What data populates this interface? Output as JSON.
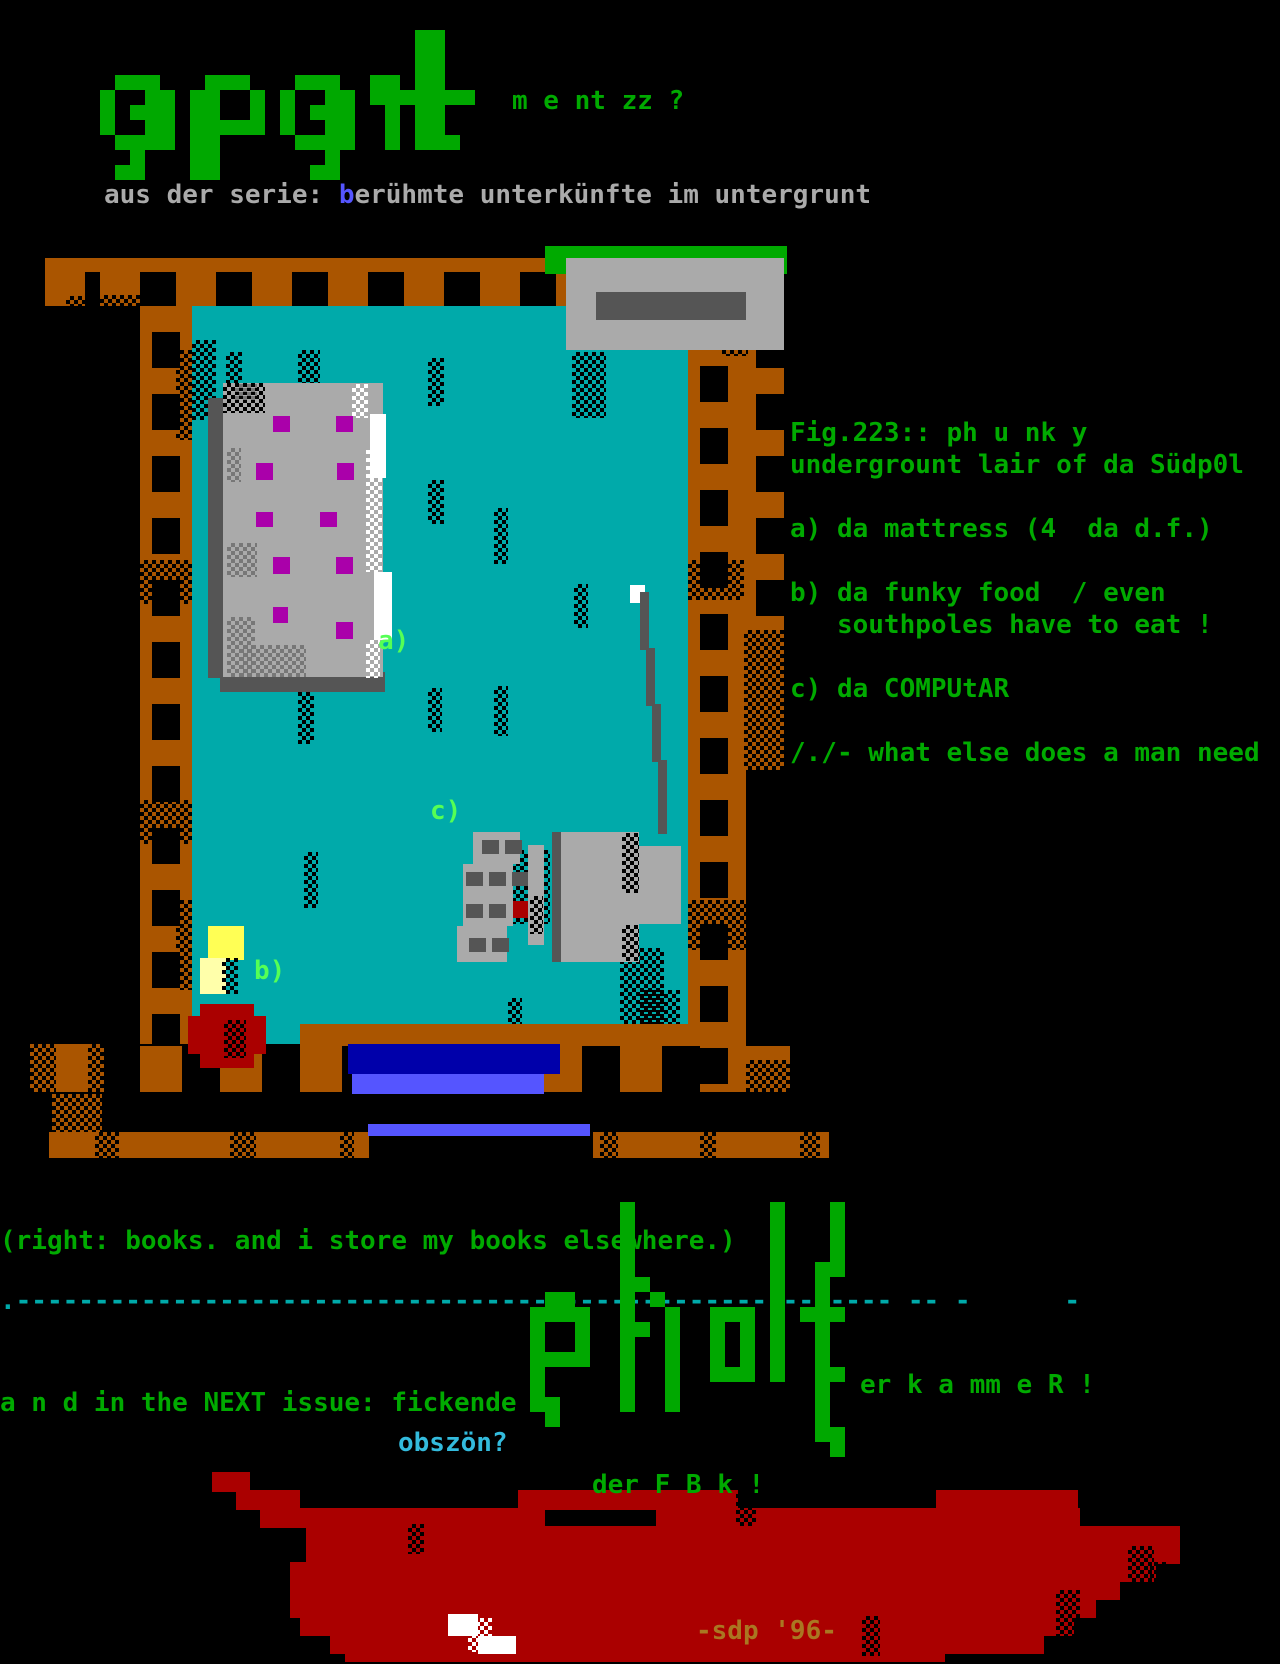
{
  "colors": {
    "green": "#00aa00",
    "bgreen": "#55ff55",
    "logo_green": "#00a800",
    "gray": "#aaaaaa",
    "dgray": "#555555",
    "white": "#ffffff",
    "brown": "#aa5500",
    "teal": "#00aaaa",
    "magenta": "#aa00aa",
    "red": "#aa0000",
    "yellow": "#ffff55",
    "lyellow": "#ffffaa",
    "blue": "#0000aa",
    "royal": "#5555ff",
    "cyan": "#00aaaa",
    "lcyan": "#33bbdd",
    "gold": "#aa7722",
    "text_blue": "#5555ff"
  },
  "header": {
    "logo_word": "apart",
    "logo_suffix": "m e nt zz ?",
    "subtitle_prefix": "aus der serie: ",
    "subtitle_highlight": "b",
    "subtitle_rest": "erühmte unterkünfte im untergrunt"
  },
  "figure": {
    "lines": [
      "Fig.223:: ph u nk y",
      "undergrount lair of da Südp0l",
      "a) da mattress (4  da d.f.)",
      "b) da funky food  / even",
      "   southpoles have to eat !",
      "c) da COMPUtAR",
      "/./- what else does a man need"
    ]
  },
  "room_labels": {
    "a": "a)",
    "b": "b)",
    "c": "c)"
  },
  "below_room": {
    "books_note": "(right: books. and i store my books elsewhere.)",
    "divider": ".-------------------------------------------------------- -- -      -",
    "next_issue": "a n d in the NEXT issue: fickende",
    "obszon": "obszön?",
    "pholt_word": "pholt",
    "pholt_suffix": "er k a mm e R !",
    "der_fbk": "der F B k !",
    "sdp_credit": "-sdp '96-"
  },
  "pixel_art": {
    "apart_map": [
      ".....................##....",
      ".....................##....",
      ".....................##....",
      ".###...###...###..##.##....",
      "#..##.##..#.#..##.#######..",
      "#.###.##..#.#.###..#.##....",
      "#..##.#####.#..##..#.##....",
      ".####.##.....####..#.###...",
      "..#...##.......#...........",
      ".##...##......##..........."
    ],
    "pholt_map": [
      "......#.........#...#..",
      "......#.........#...#..",
      "......#.........#...#..",
      "......#.........#...#..",
      "......#.........#..##..",
      "......##........#..#...",
      ".##...#.#.......#..#...",
      "####..#..#..###.#.###..",
      "#..#..##.#..#.#.#..#...",
      "#..#..#..#..#.#.#..#...",
      "####..#..#..#.#.#..#...",
      "#.....#..#..###.#..##..",
      "#.....#..#.........#...",
      "##....#..#.........#...",
      ".#.................#...",
      "...................##..",
      "....................#.."
    ]
  },
  "scene": {
    "objects": [
      {
        "name": "floor",
        "rects": [
          [
            190,
            306,
            498,
            738,
            "teal"
          ],
          [
            298,
            350,
            22,
            58,
            "dots"
          ],
          [
            226,
            352,
            16,
            50,
            "dots"
          ],
          [
            428,
            358,
            16,
            48,
            "dots"
          ],
          [
            572,
            352,
            34,
            66,
            "dots"
          ],
          [
            360,
            445,
            16,
            40,
            "dots"
          ],
          [
            428,
            480,
            16,
            44,
            "dots"
          ],
          [
            494,
            508,
            14,
            56,
            "dots"
          ],
          [
            574,
            584,
            14,
            44,
            "dots"
          ],
          [
            298,
            688,
            16,
            56,
            "dots"
          ],
          [
            428,
            688,
            14,
            44,
            "dots"
          ],
          [
            494,
            686,
            14,
            50,
            "dots"
          ],
          [
            304,
            852,
            14,
            56,
            "dots"
          ],
          [
            508,
            850,
            42,
            74,
            "dots"
          ],
          [
            620,
            948,
            44,
            86,
            "dots"
          ],
          [
            508,
            998,
            14,
            36,
            "dots"
          ],
          [
            192,
            340,
            24,
            80,
            "dots"
          ],
          [
            640,
            990,
            40,
            52,
            "dots"
          ]
        ]
      },
      {
        "name": "left-ladder",
        "rects": [
          [
            140,
            306,
            52,
            738,
            "lv"
          ],
          [
            176,
            350,
            16,
            90,
            "dots"
          ],
          [
            140,
            560,
            52,
            44,
            "dots"
          ],
          [
            140,
            800,
            52,
            44,
            "dots"
          ],
          [
            176,
            900,
            16,
            90,
            "dots"
          ]
        ]
      },
      {
        "name": "right-inner-ladder",
        "rects": [
          [
            688,
            340,
            58,
            752,
            "lv"
          ],
          [
            688,
            560,
            58,
            40,
            "dots"
          ],
          [
            688,
            900,
            58,
            50,
            "dots"
          ]
        ]
      },
      {
        "name": "right-outer-ladder",
        "rects": [
          [
            744,
            306,
            40,
            324,
            "lv"
          ],
          [
            744,
            630,
            40,
            140,
            "brown"
          ],
          [
            744,
            630,
            40,
            140,
            "dots"
          ],
          [
            722,
            306,
            26,
            50,
            "dots"
          ]
        ]
      },
      {
        "name": "top-frame",
        "rects": [
          [
            45,
            258,
            56,
            48,
            "lh"
          ],
          [
            66,
            296,
            36,
            22,
            "dots"
          ],
          [
            100,
            258,
            468,
            48,
            "lh"
          ],
          [
            722,
            258,
            62,
            48,
            "lh"
          ],
          [
            100,
            295,
            40,
            24,
            "dots"
          ]
        ]
      },
      {
        "name": "bottom-frame",
        "rects": [
          [
            300,
            1024,
            400,
            22,
            "brown"
          ],
          [
            140,
            1046,
            560,
            46,
            "rungs"
          ],
          [
            30,
            1044,
            74,
            48,
            "brown"
          ],
          [
            30,
            1044,
            26,
            48,
            "dots"
          ],
          [
            88,
            1044,
            16,
            48,
            "dots"
          ],
          [
            52,
            1094,
            50,
            56,
            "brown"
          ],
          [
            52,
            1094,
            50,
            56,
            "dots"
          ],
          [
            746,
            1046,
            44,
            46,
            "brown"
          ],
          [
            746,
            1060,
            44,
            32,
            "dots"
          ],
          [
            49,
            1132,
            320,
            26,
            "brown"
          ],
          [
            593,
            1132,
            236,
            26,
            "brown"
          ],
          [
            95,
            1132,
            24,
            26,
            "dots"
          ],
          [
            230,
            1132,
            26,
            26,
            "dots"
          ],
          [
            340,
            1132,
            14,
            26,
            "dots"
          ],
          [
            600,
            1132,
            18,
            26,
            "dots"
          ],
          [
            700,
            1132,
            16,
            26,
            "dots"
          ],
          [
            800,
            1132,
            20,
            26,
            "dots"
          ]
        ]
      },
      {
        "name": "bottom-door",
        "rects": [
          [
            348,
            1044,
            212,
            30,
            "blue"
          ],
          [
            352,
            1074,
            192,
            20,
            "royal"
          ],
          [
            368,
            1124,
            222,
            12,
            "royal"
          ]
        ]
      },
      {
        "name": "top-door",
        "rects": [
          [
            545,
            246,
            242,
            28,
            "green"
          ],
          [
            566,
            258,
            218,
            92,
            "gray"
          ],
          [
            596,
            292,
            150,
            28,
            "dgray"
          ]
        ]
      },
      {
        "name": "mattress",
        "rects": [
          [
            208,
            398,
            16,
            280,
            "dgray"
          ],
          [
            220,
            672,
            165,
            20,
            "dgray"
          ],
          [
            223,
            383,
            160,
            294,
            "gray"
          ],
          [
            223,
            383,
            42,
            30,
            "dots"
          ],
          [
            235,
            384,
            22,
            16,
            "gdots"
          ],
          [
            227,
            448,
            14,
            34,
            "gdots"
          ],
          [
            227,
            543,
            30,
            34,
            "gdots"
          ],
          [
            227,
            617,
            28,
            60,
            "gdots"
          ],
          [
            240,
            645,
            66,
            32,
            "gdots"
          ],
          [
            370,
            414,
            16,
            64,
            "white"
          ],
          [
            374,
            572,
            18,
            68,
            "white"
          ],
          [
            352,
            384,
            16,
            34,
            "wdots"
          ],
          [
            366,
            446,
            16,
            126,
            "wdots"
          ],
          [
            366,
            640,
            14,
            38,
            "wdots"
          ],
          [
            273,
            416,
            17,
            16,
            "magenta"
          ],
          [
            336,
            416,
            17,
            16,
            "magenta"
          ],
          [
            256,
            463,
            17,
            17,
            "magenta"
          ],
          [
            337,
            463,
            17,
            17,
            "magenta"
          ],
          [
            256,
            512,
            17,
            15,
            "magenta"
          ],
          [
            320,
            512,
            17,
            15,
            "magenta"
          ],
          [
            273,
            557,
            17,
            17,
            "magenta"
          ],
          [
            336,
            557,
            17,
            17,
            "magenta"
          ],
          [
            273,
            607,
            15,
            16,
            "magenta"
          ],
          [
            336,
            622,
            17,
            17,
            "magenta"
          ]
        ]
      },
      {
        "name": "computer",
        "rects": [
          [
            473,
            832,
            47,
            32,
            "gray"
          ],
          [
            463,
            864,
            50,
            62,
            "gray"
          ],
          [
            457,
            926,
            50,
            36,
            "gray"
          ],
          [
            482,
            840,
            17,
            14,
            "dgray"
          ],
          [
            505,
            840,
            17,
            14,
            "dgray"
          ],
          [
            466,
            872,
            17,
            14,
            "dgray"
          ],
          [
            489,
            872,
            17,
            14,
            "dgray"
          ],
          [
            512,
            872,
            17,
            14,
            "dgray"
          ],
          [
            466,
            904,
            17,
            14,
            "dgray"
          ],
          [
            489,
            904,
            17,
            14,
            "dgray"
          ],
          [
            469,
            938,
            17,
            14,
            "dgray"
          ],
          [
            492,
            938,
            17,
            14,
            "dgray"
          ],
          [
            513,
            901,
            15,
            17,
            "red"
          ],
          [
            528,
            845,
            16,
            100,
            "gray"
          ],
          [
            530,
            896,
            13,
            38,
            "dots"
          ],
          [
            552,
            832,
            9,
            130,
            "dgray"
          ],
          [
            561,
            832,
            78,
            130,
            "gray"
          ],
          [
            639,
            846,
            42,
            78,
            "gray"
          ],
          [
            622,
            833,
            17,
            60,
            "dots"
          ],
          [
            622,
            925,
            17,
            36,
            "dots"
          ],
          [
            630,
            585,
            15,
            18,
            "white"
          ],
          [
            640,
            592,
            9,
            58,
            "dgray"
          ],
          [
            646,
            648,
            9,
            58,
            "dgray"
          ],
          [
            652,
            704,
            9,
            58,
            "dgray"
          ],
          [
            658,
            760,
            9,
            74,
            "dgray"
          ]
        ]
      },
      {
        "name": "food",
        "rects": [
          [
            208,
            926,
            36,
            34,
            "yellow"
          ],
          [
            200,
            958,
            26,
            36,
            "lyellow"
          ],
          [
            222,
            958,
            16,
            36,
            "dots"
          ]
        ]
      },
      {
        "name": "room-blob",
        "rects": [
          [
            200,
            1004,
            54,
            14,
            "red"
          ],
          [
            188,
            1016,
            78,
            38,
            "red"
          ],
          [
            200,
            1052,
            54,
            16,
            "red"
          ],
          [
            224,
            1020,
            22,
            38,
            "dots"
          ]
        ]
      },
      {
        "name": "blood-pool",
        "rects": [
          [
            212,
            1472,
            38,
            20,
            "red"
          ],
          [
            236,
            1490,
            64,
            20,
            "red"
          ],
          [
            518,
            1490,
            220,
            20,
            "red"
          ],
          [
            936,
            1490,
            142,
            20,
            "red"
          ],
          [
            260,
            1508,
            285,
            20,
            "red"
          ],
          [
            656,
            1508,
            424,
            20,
            "red"
          ],
          [
            306,
            1526,
            874,
            20,
            "red"
          ],
          [
            306,
            1544,
            874,
            20,
            "red"
          ],
          [
            290,
            1562,
            866,
            20,
            "red"
          ],
          [
            290,
            1580,
            830,
            20,
            "red"
          ],
          [
            290,
            1598,
            806,
            20,
            "red"
          ],
          [
            300,
            1616,
            774,
            20,
            "red"
          ],
          [
            330,
            1634,
            714,
            20,
            "red"
          ],
          [
            345,
            1652,
            600,
            10,
            "red"
          ],
          [
            736,
            1490,
            20,
            36,
            "dots"
          ],
          [
            1128,
            1546,
            26,
            58,
            "dots"
          ],
          [
            1056,
            1590,
            24,
            54,
            "dots"
          ],
          [
            862,
            1616,
            18,
            40,
            "dots"
          ],
          [
            1150,
            1562,
            20,
            40,
            "dots"
          ],
          [
            408,
            1524,
            16,
            30,
            "dots"
          ],
          [
            448,
            1614,
            30,
            22,
            "white"
          ],
          [
            478,
            1636,
            38,
            18,
            "white"
          ],
          [
            468,
            1618,
            24,
            34,
            "wdots"
          ]
        ]
      }
    ]
  }
}
